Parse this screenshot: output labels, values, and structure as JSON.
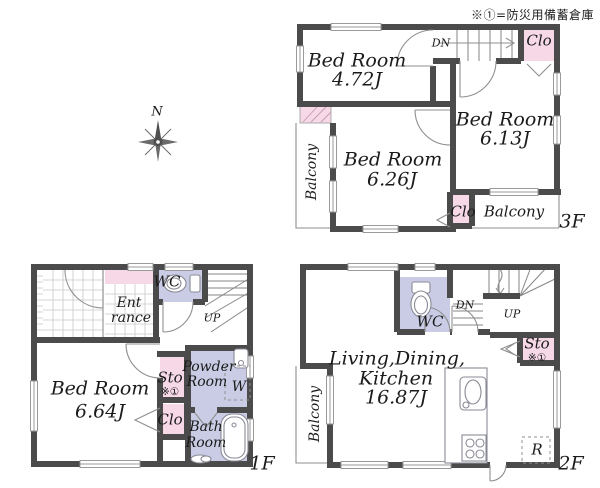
{
  "note": "※①=防災用備蓄倉庫",
  "compass": {
    "north": "N"
  },
  "colors": {
    "wall": "#4b4b4b",
    "pink": "#f6d8e6",
    "lavender": "#c9cce4",
    "text": "#1b1b1b",
    "thin": "#8f8f8f",
    "grid": "#c9c9c9"
  },
  "floor3": {
    "label": "3F",
    "bedroom1": {
      "name": "Bed Room",
      "area": "4.72J"
    },
    "bedroom2": {
      "name": "Bed Room",
      "area": "6.26J"
    },
    "bedroom3": {
      "name": "Bed Room",
      "area": "6.13J"
    },
    "closet_top": "Clo",
    "closet_bottom": "Clo",
    "balcony_side": "Balcony",
    "balcony_rear": "Balcony",
    "stairs_down": "DN"
  },
  "floor1": {
    "label": "1F",
    "entrance": {
      "line1": "Ent",
      "line2": "rance"
    },
    "toilet": "WC",
    "stairs_up": "UP",
    "bedroom": {
      "name": "Bed Room",
      "area": "6.64J"
    },
    "storage": "Sto",
    "storage_note": "※①",
    "closet": "Clo",
    "powder_room": {
      "line1": "Powder",
      "line2": "Room"
    },
    "washer": "W",
    "bathroom": {
      "line1": "Bath",
      "line2": "Room"
    }
  },
  "floor2": {
    "label": "2F",
    "toilet": "WC",
    "stairs_down": "DN",
    "stairs_up": "UP",
    "storage": "Sto",
    "storage_note": "※①",
    "ldk": {
      "line1": "Living,Dining,",
      "line2": "Kitchen",
      "area": "16.87J"
    },
    "balcony": "Balcony",
    "refrigerator": "R"
  }
}
